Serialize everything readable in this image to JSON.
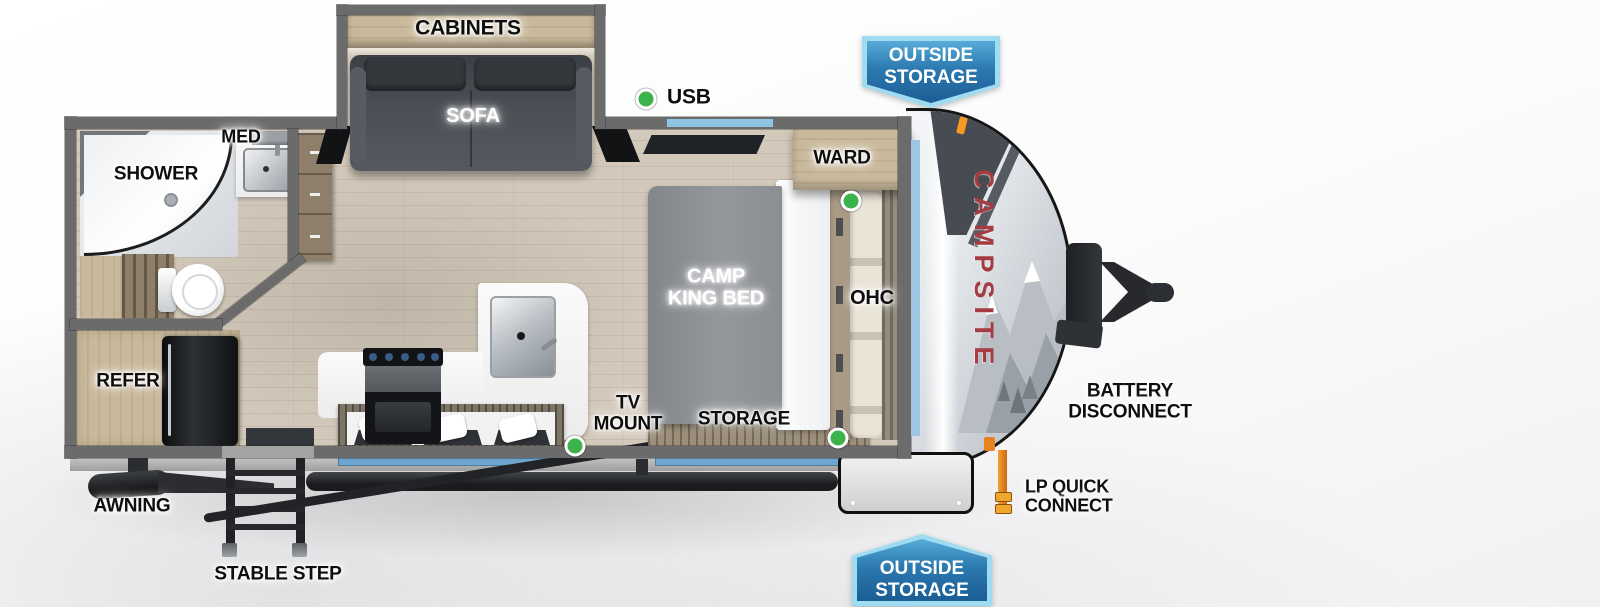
{
  "colors": {
    "badge_border": "#9fdcf2",
    "badge_blue_light": "#4a9fd0",
    "badge_blue_dark": "#1b5d94",
    "marker_green": "#3bb24a",
    "brand_red": "#a43c41",
    "window_blue": "#8fc4e4",
    "wall_gray": "#6b6b6b"
  },
  "badges": {
    "top_outside_storage": {
      "line1": "OUTSIDE",
      "line2": "STORAGE"
    },
    "bottom_outside_storage": {
      "line1": "OUTSIDE",
      "line2": "STORAGE"
    }
  },
  "exterior_labels": {
    "usb": "USB",
    "battery_disconnect": {
      "line1": "BATTERY",
      "line2": "DISCONNECT"
    },
    "lp_quick_connect": {
      "line1": "LP QUICK",
      "line2": "CONNECT"
    },
    "awning": "AWNING",
    "stable_step": "STABLE STEP",
    "brand": "CAMPSITE"
  },
  "interior_labels": {
    "cabinets": "CABINETS",
    "sofa": "SOFA",
    "med": "MED",
    "shower": "SHOWER",
    "ward": "WARD",
    "bed": {
      "line1": "CAMP",
      "line2": "KING BED"
    },
    "ohc": "OHC",
    "refer": "REFER",
    "tv_mount": {
      "line1": "TV",
      "line2": "MOUNT"
    },
    "storage": "STORAGE"
  }
}
